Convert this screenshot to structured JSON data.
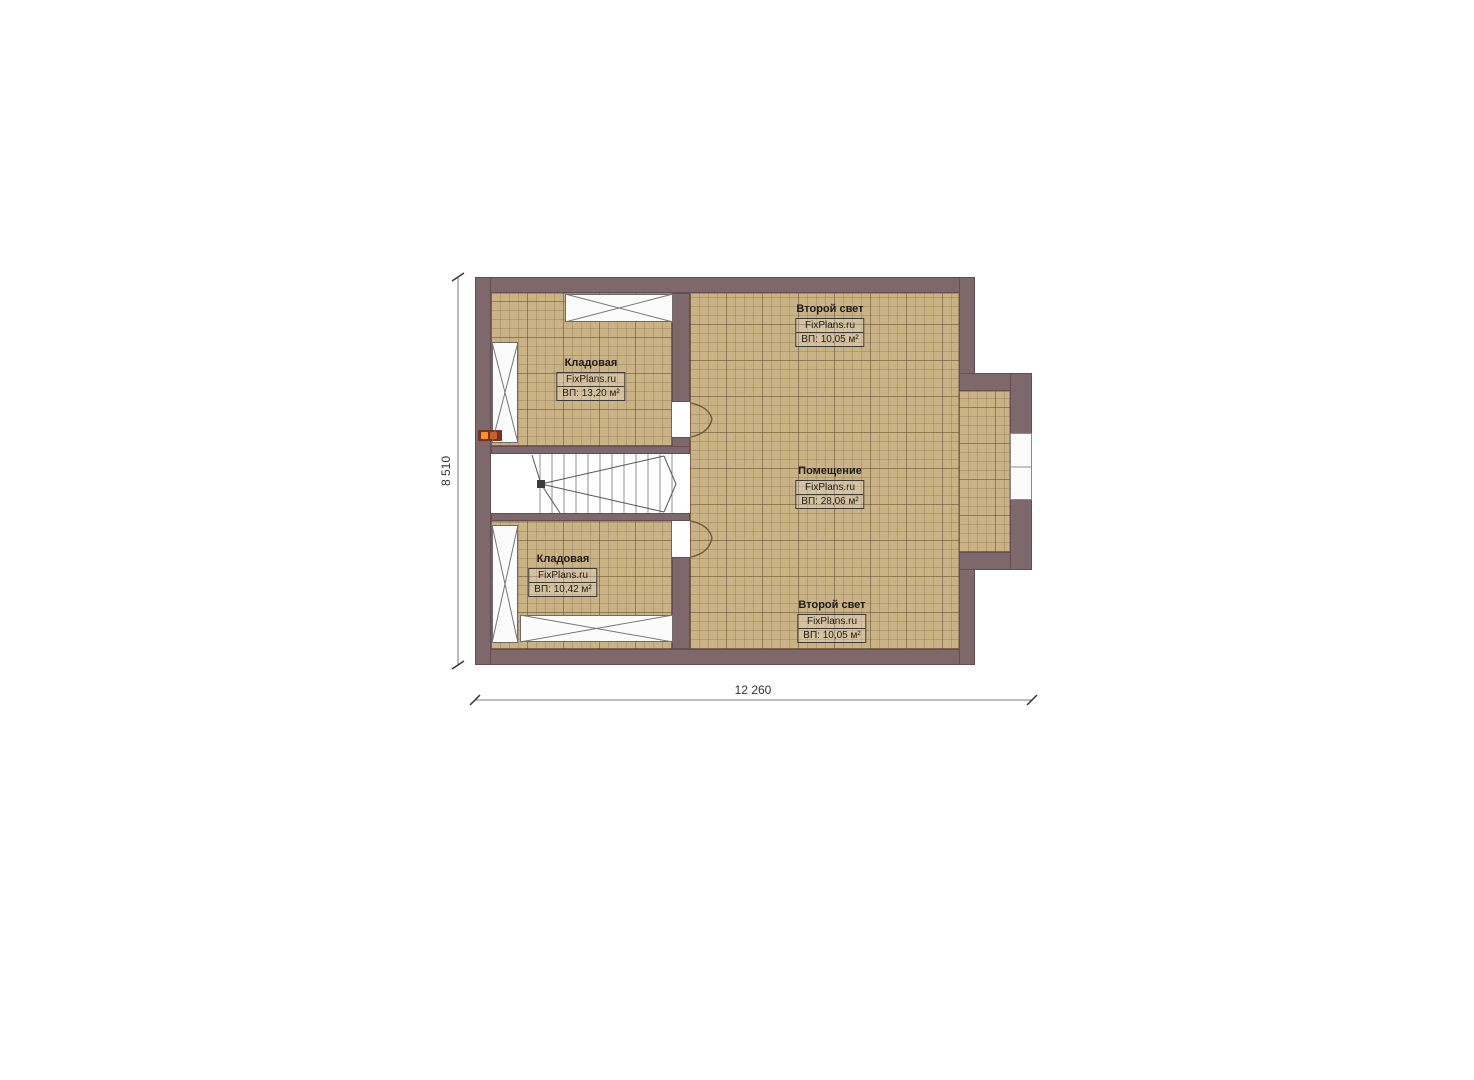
{
  "plan": {
    "rooms": [
      {
        "name": "Кладовая",
        "brand": "FixPlans.ru",
        "area": "ВП: 13,20 м²"
      },
      {
        "name": "Второй свет",
        "brand": "FixPlans.ru",
        "area": "ВП: 10,05 м²"
      },
      {
        "name": "Помещение",
        "brand": "FixPlans.ru",
        "area": "ВП: 28,06 м²"
      },
      {
        "name": "Кладовая",
        "brand": "FixPlans.ru",
        "area": "ВП: 10,42 м²"
      },
      {
        "name": "Второй свет",
        "brand": "FixPlans.ru",
        "area": "ВП: 10,05 м²"
      }
    ],
    "dimensions": {
      "height_label": "8 510",
      "width_label": "12 260"
    },
    "colors": {
      "wall": "#7d696b",
      "floor_tile": "#c9b284",
      "fixture_orange": "#ff9022"
    }
  }
}
